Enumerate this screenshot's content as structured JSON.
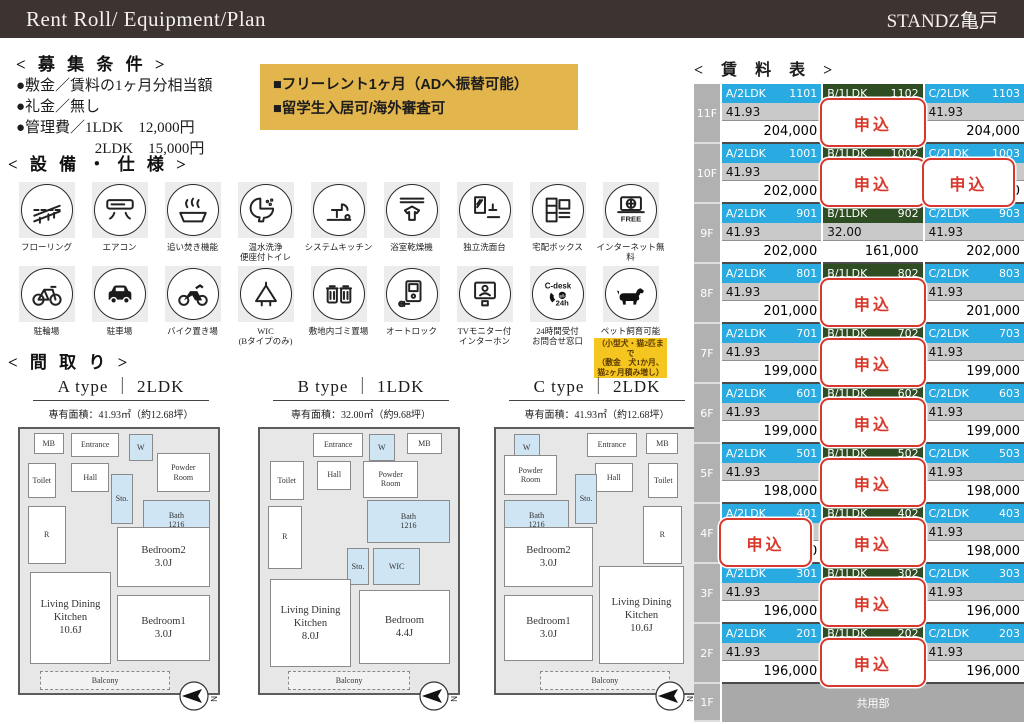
{
  "header": {
    "title": "Rent Roll/ Equipment/Plan",
    "building": "STANDZ亀戸"
  },
  "conditions": {
    "title": "< 募 集 条 件 >",
    "items": [
      "●敷金／賃料の1ヶ月分相当額",
      "●礼金／無し",
      "●管理費／1LDK　12,000円",
      "　　　　　 2LDK　15,000円"
    ]
  },
  "notice": {
    "lines": [
      "■フリーレント1ヶ月（ADへ振替可能）",
      "■留学生入居可/海外審査可"
    ]
  },
  "equipment": {
    "title": "< 設 備 ・ 仕 様 >",
    "row1": [
      {
        "icon": "flooring",
        "label": "フローリング"
      },
      {
        "icon": "aircon",
        "label": "エアコン"
      },
      {
        "icon": "reheat",
        "label": "追い焚き機能"
      },
      {
        "icon": "washlet",
        "label": "温水洗浄\n便座付トイレ"
      },
      {
        "icon": "kitchen",
        "label": "システムキッチン"
      },
      {
        "icon": "bathdryer",
        "label": "浴室乾燥機"
      },
      {
        "icon": "washbasin",
        "label": "独立洗面台"
      },
      {
        "icon": "deliverybox",
        "label": "宅配ボックス"
      },
      {
        "icon": "internet",
        "label": "インターネット無料"
      }
    ],
    "row2": [
      {
        "icon": "bicycle",
        "label": "駐輪場"
      },
      {
        "icon": "car",
        "label": "駐車場"
      },
      {
        "icon": "motorcycle",
        "label": "バイク置き場"
      },
      {
        "icon": "wic",
        "label": "WIC\n(Bタイプのみ)"
      },
      {
        "icon": "garbage",
        "label": "敷地内ゴミ置場"
      },
      {
        "icon": "autolock",
        "label": "オートロック"
      },
      {
        "icon": "tvintercom",
        "label": "TVモニター付\nインターホン"
      },
      {
        "icon": "cdesk",
        "label": "24時間受付\nお問合せ窓口"
      },
      {
        "icon": "pet",
        "label": "ペット飼育可能"
      }
    ],
    "pet_note": "（小型犬・猫2匹まで\n（敷金　犬1か月、\n猫2ヶ月積み増し）"
  },
  "plans": {
    "title": "< 間 取 り >",
    "items": [
      {
        "title": "A type ｜ 2LDK",
        "area": "専有面積：41.93㎡（約12.68坪）",
        "rooms": [
          {
            "label": "MB",
            "x": 7,
            "y": 1.5,
            "w": 15,
            "h": 8
          },
          {
            "label": "Entrance",
            "x": 26,
            "y": 1.5,
            "w": 24,
            "h": 9
          },
          {
            "label": "W",
            "x": 55,
            "y": 2,
            "w": 12,
            "h": 10,
            "s": 1
          },
          {
            "label": "Powder\nRoom",
            "x": 69,
            "y": 9,
            "w": 27,
            "h": 15
          },
          {
            "label": "Toilet",
            "x": 4,
            "y": 13,
            "w": 14,
            "h": 13
          },
          {
            "label": "Hall",
            "x": 26,
            "y": 13,
            "w": 19,
            "h": 11
          },
          {
            "label": "Sto.",
            "x": 46,
            "y": 17,
            "w": 11,
            "h": 19,
            "s": 1
          },
          {
            "label": "Bath\n1216",
            "x": 62,
            "y": 27,
            "w": 34,
            "h": 15,
            "s": 1
          },
          {
            "label": "R",
            "x": 4,
            "y": 29,
            "w": 19,
            "h": 22
          },
          {
            "label": "Bedroom2\n3.0J",
            "x": 49,
            "y": 37,
            "w": 47,
            "h": 23,
            "big": 1
          },
          {
            "label": "Bedroom1\n3.0J",
            "x": 49,
            "y": 63,
            "w": 47,
            "h": 25,
            "big": 1
          },
          {
            "label": "Living Dining\nKitchen\n10.6J",
            "x": 5,
            "y": 54,
            "w": 41,
            "h": 35,
            "big": 1
          },
          {
            "label": "Balcony",
            "x": 10,
            "y": 91.5,
            "w": 66,
            "h": 7.5,
            "d": 1
          }
        ]
      },
      {
        "title": "B type ｜ 1LDK",
        "area": "専有面積：32.00㎡（約9.68坪）",
        "rooms": [
          {
            "label": "Entrance",
            "x": 27,
            "y": 1.5,
            "w": 25,
            "h": 9
          },
          {
            "label": "W",
            "x": 55,
            "y": 2,
            "w": 13,
            "h": 10,
            "s": 1
          },
          {
            "label": "MB",
            "x": 74,
            "y": 1.5,
            "w": 18,
            "h": 8
          },
          {
            "label": "Toilet",
            "x": 5,
            "y": 12,
            "w": 17,
            "h": 15
          },
          {
            "label": "Hall",
            "x": 29,
            "y": 12,
            "w": 17,
            "h": 11
          },
          {
            "label": "Powder\nRoom",
            "x": 52,
            "y": 12,
            "w": 28,
            "h": 14
          },
          {
            "label": "Bath\n1216",
            "x": 54,
            "y": 27,
            "w": 42,
            "h": 16,
            "s": 1
          },
          {
            "label": "R",
            "x": 4,
            "y": 29,
            "w": 17,
            "h": 24
          },
          {
            "label": "Sto.",
            "x": 44,
            "y": 45,
            "w": 11,
            "h": 14,
            "s": 1
          },
          {
            "label": "WIC",
            "x": 57,
            "y": 45,
            "w": 24,
            "h": 14,
            "s": 1
          },
          {
            "label": "Living Dining\nKitchen\n8.0J",
            "x": 5,
            "y": 57,
            "w": 41,
            "h": 33,
            "big": 1
          },
          {
            "label": "Bedroom\n4.4J",
            "x": 50,
            "y": 61,
            "w": 46,
            "h": 28,
            "big": 1
          },
          {
            "label": "Balcony",
            "x": 14,
            "y": 91.5,
            "w": 62,
            "h": 7.5,
            "d": 1
          }
        ]
      },
      {
        "title": "C type ｜ 2LDK",
        "area": "専有面積：41.93㎡（約12.68坪）",
        "rooms": [
          {
            "label": "W",
            "x": 9,
            "y": 2,
            "w": 13,
            "h": 10,
            "s": 1
          },
          {
            "label": "Powder\nRoom",
            "x": 4,
            "y": 10,
            "w": 27,
            "h": 15
          },
          {
            "label": "Entrance",
            "x": 46,
            "y": 1.5,
            "w": 25,
            "h": 9
          },
          {
            "label": "MB",
            "x": 76,
            "y": 1.5,
            "w": 16,
            "h": 8
          },
          {
            "label": "Hall",
            "x": 50,
            "y": 13,
            "w": 19,
            "h": 11
          },
          {
            "label": "Toilet",
            "x": 77,
            "y": 13,
            "w": 15,
            "h": 13
          },
          {
            "label": "Bath\n1216",
            "x": 4,
            "y": 27,
            "w": 33,
            "h": 15,
            "s": 1
          },
          {
            "label": "Sto.",
            "x": 40,
            "y": 17,
            "w": 11,
            "h": 19,
            "s": 1
          },
          {
            "label": "R",
            "x": 74,
            "y": 29,
            "w": 20,
            "h": 22
          },
          {
            "label": "Bedroom2\n3.0J",
            "x": 4,
            "y": 37,
            "w": 45,
            "h": 23,
            "big": 1
          },
          {
            "label": "Bedroom1\n3.0J",
            "x": 4,
            "y": 63,
            "w": 45,
            "h": 25,
            "big": 1
          },
          {
            "label": "Living Dining\nKitchen\n10.6J",
            "x": 52,
            "y": 52,
            "w": 43,
            "h": 37,
            "big": 1
          },
          {
            "label": "Balcony",
            "x": 22,
            "y": 91.5,
            "w": 66,
            "h": 7.5,
            "d": 1
          }
        ]
      }
    ]
  },
  "rent_table": {
    "title": "< 賃 料 表 >",
    "applied_label": "申込",
    "colors": {
      "a_header": "#29aae1",
      "b_header": "#2f4d22",
      "c_header": "#29aae1"
    },
    "common_area_label": "共用部",
    "ground_floor": "1F",
    "floors": [
      {
        "floor": "11F",
        "units": [
          {
            "type": "A/2LDK",
            "room": "1101",
            "size": "41.93",
            "price": "204,000",
            "applied": false
          },
          {
            "type": "B/1LDK",
            "room": "1102",
            "size": "",
            "price": "",
            "applied": true
          },
          {
            "type": "C/2LDK",
            "room": "1103",
            "size": "41.93",
            "price": "204,000",
            "applied": false
          }
        ]
      },
      {
        "floor": "10F",
        "units": [
          {
            "type": "A/2LDK",
            "room": "1001",
            "size": "41.93",
            "price": "202,000",
            "applied": false
          },
          {
            "type": "B/1LDK",
            "room": "1002",
            "size": "",
            "price": "",
            "applied": true
          },
          {
            "type": "C/2LDK",
            "room": "1003",
            "size": "41.93",
            "price": "202,000",
            "applied": true,
            "peek": true
          }
        ]
      },
      {
        "floor": "9F",
        "units": [
          {
            "type": "A/2LDK",
            "room": "901",
            "size": "41.93",
            "price": "202,000",
            "applied": false
          },
          {
            "type": "B/1LDK",
            "room": "902",
            "size": "32.00",
            "price": "161,000",
            "applied": false
          },
          {
            "type": "C/2LDK",
            "room": "903",
            "size": "41.93",
            "price": "202,000",
            "applied": false
          }
        ]
      },
      {
        "floor": "8F",
        "units": [
          {
            "type": "A/2LDK",
            "room": "801",
            "size": "41.93",
            "price": "201,000",
            "applied": false
          },
          {
            "type": "B/1LDK",
            "room": "802",
            "size": "",
            "price": "",
            "applied": true
          },
          {
            "type": "C/2LDK",
            "room": "803",
            "size": "41.93",
            "price": "201,000",
            "applied": false
          }
        ]
      },
      {
        "floor": "7F",
        "units": [
          {
            "type": "A/2LDK",
            "room": "701",
            "size": "41.93",
            "price": "199,000",
            "applied": false
          },
          {
            "type": "B/1LDK",
            "room": "702",
            "size": "",
            "price": "",
            "applied": true
          },
          {
            "type": "C/2LDK",
            "room": "703",
            "size": "41.93",
            "price": "199,000",
            "applied": false
          }
        ]
      },
      {
        "floor": "6F",
        "units": [
          {
            "type": "A/2LDK",
            "room": "601",
            "size": "41.93",
            "price": "199,000",
            "applied": false
          },
          {
            "type": "B/1LDK",
            "room": "602",
            "size": "",
            "price": "",
            "applied": true
          },
          {
            "type": "C/2LDK",
            "room": "603",
            "size": "41.93",
            "price": "199,000",
            "applied": false
          }
        ]
      },
      {
        "floor": "5F",
        "units": [
          {
            "type": "A/2LDK",
            "room": "501",
            "size": "41.93",
            "price": "198,000",
            "applied": false
          },
          {
            "type": "B/1LDK",
            "room": "502",
            "size": "",
            "price": "",
            "applied": true
          },
          {
            "type": "C/2LDK",
            "room": "503",
            "size": "41.93",
            "price": "198,000",
            "applied": false
          }
        ]
      },
      {
        "floor": "4F",
        "units": [
          {
            "type": "A/2LDK",
            "room": "401",
            "size": "41.93",
            "price": "198,000",
            "applied": true,
            "peek": true
          },
          {
            "type": "B/1LDK",
            "room": "402",
            "size": "",
            "price": "",
            "applied": true
          },
          {
            "type": "C/2LDK",
            "room": "403",
            "size": "41.93",
            "price": "198,000",
            "applied": false
          }
        ]
      },
      {
        "floor": "3F",
        "units": [
          {
            "type": "A/2LDK",
            "room": "301",
            "size": "41.93",
            "price": "196,000",
            "applied": false
          },
          {
            "type": "B/1LDK",
            "room": "302",
            "size": "",
            "price": "",
            "applied": true
          },
          {
            "type": "C/2LDK",
            "room": "303",
            "size": "41.93",
            "price": "196,000",
            "applied": false
          }
        ]
      },
      {
        "floor": "2F",
        "units": [
          {
            "type": "A/2LDK",
            "room": "201",
            "size": "41.93",
            "price": "196,000",
            "applied": false
          },
          {
            "type": "B/1LDK",
            "room": "202",
            "size": "",
            "price": "",
            "applied": true
          },
          {
            "type": "C/2LDK",
            "room": "203",
            "size": "41.93",
            "price": "196,000",
            "applied": false
          }
        ]
      }
    ]
  }
}
